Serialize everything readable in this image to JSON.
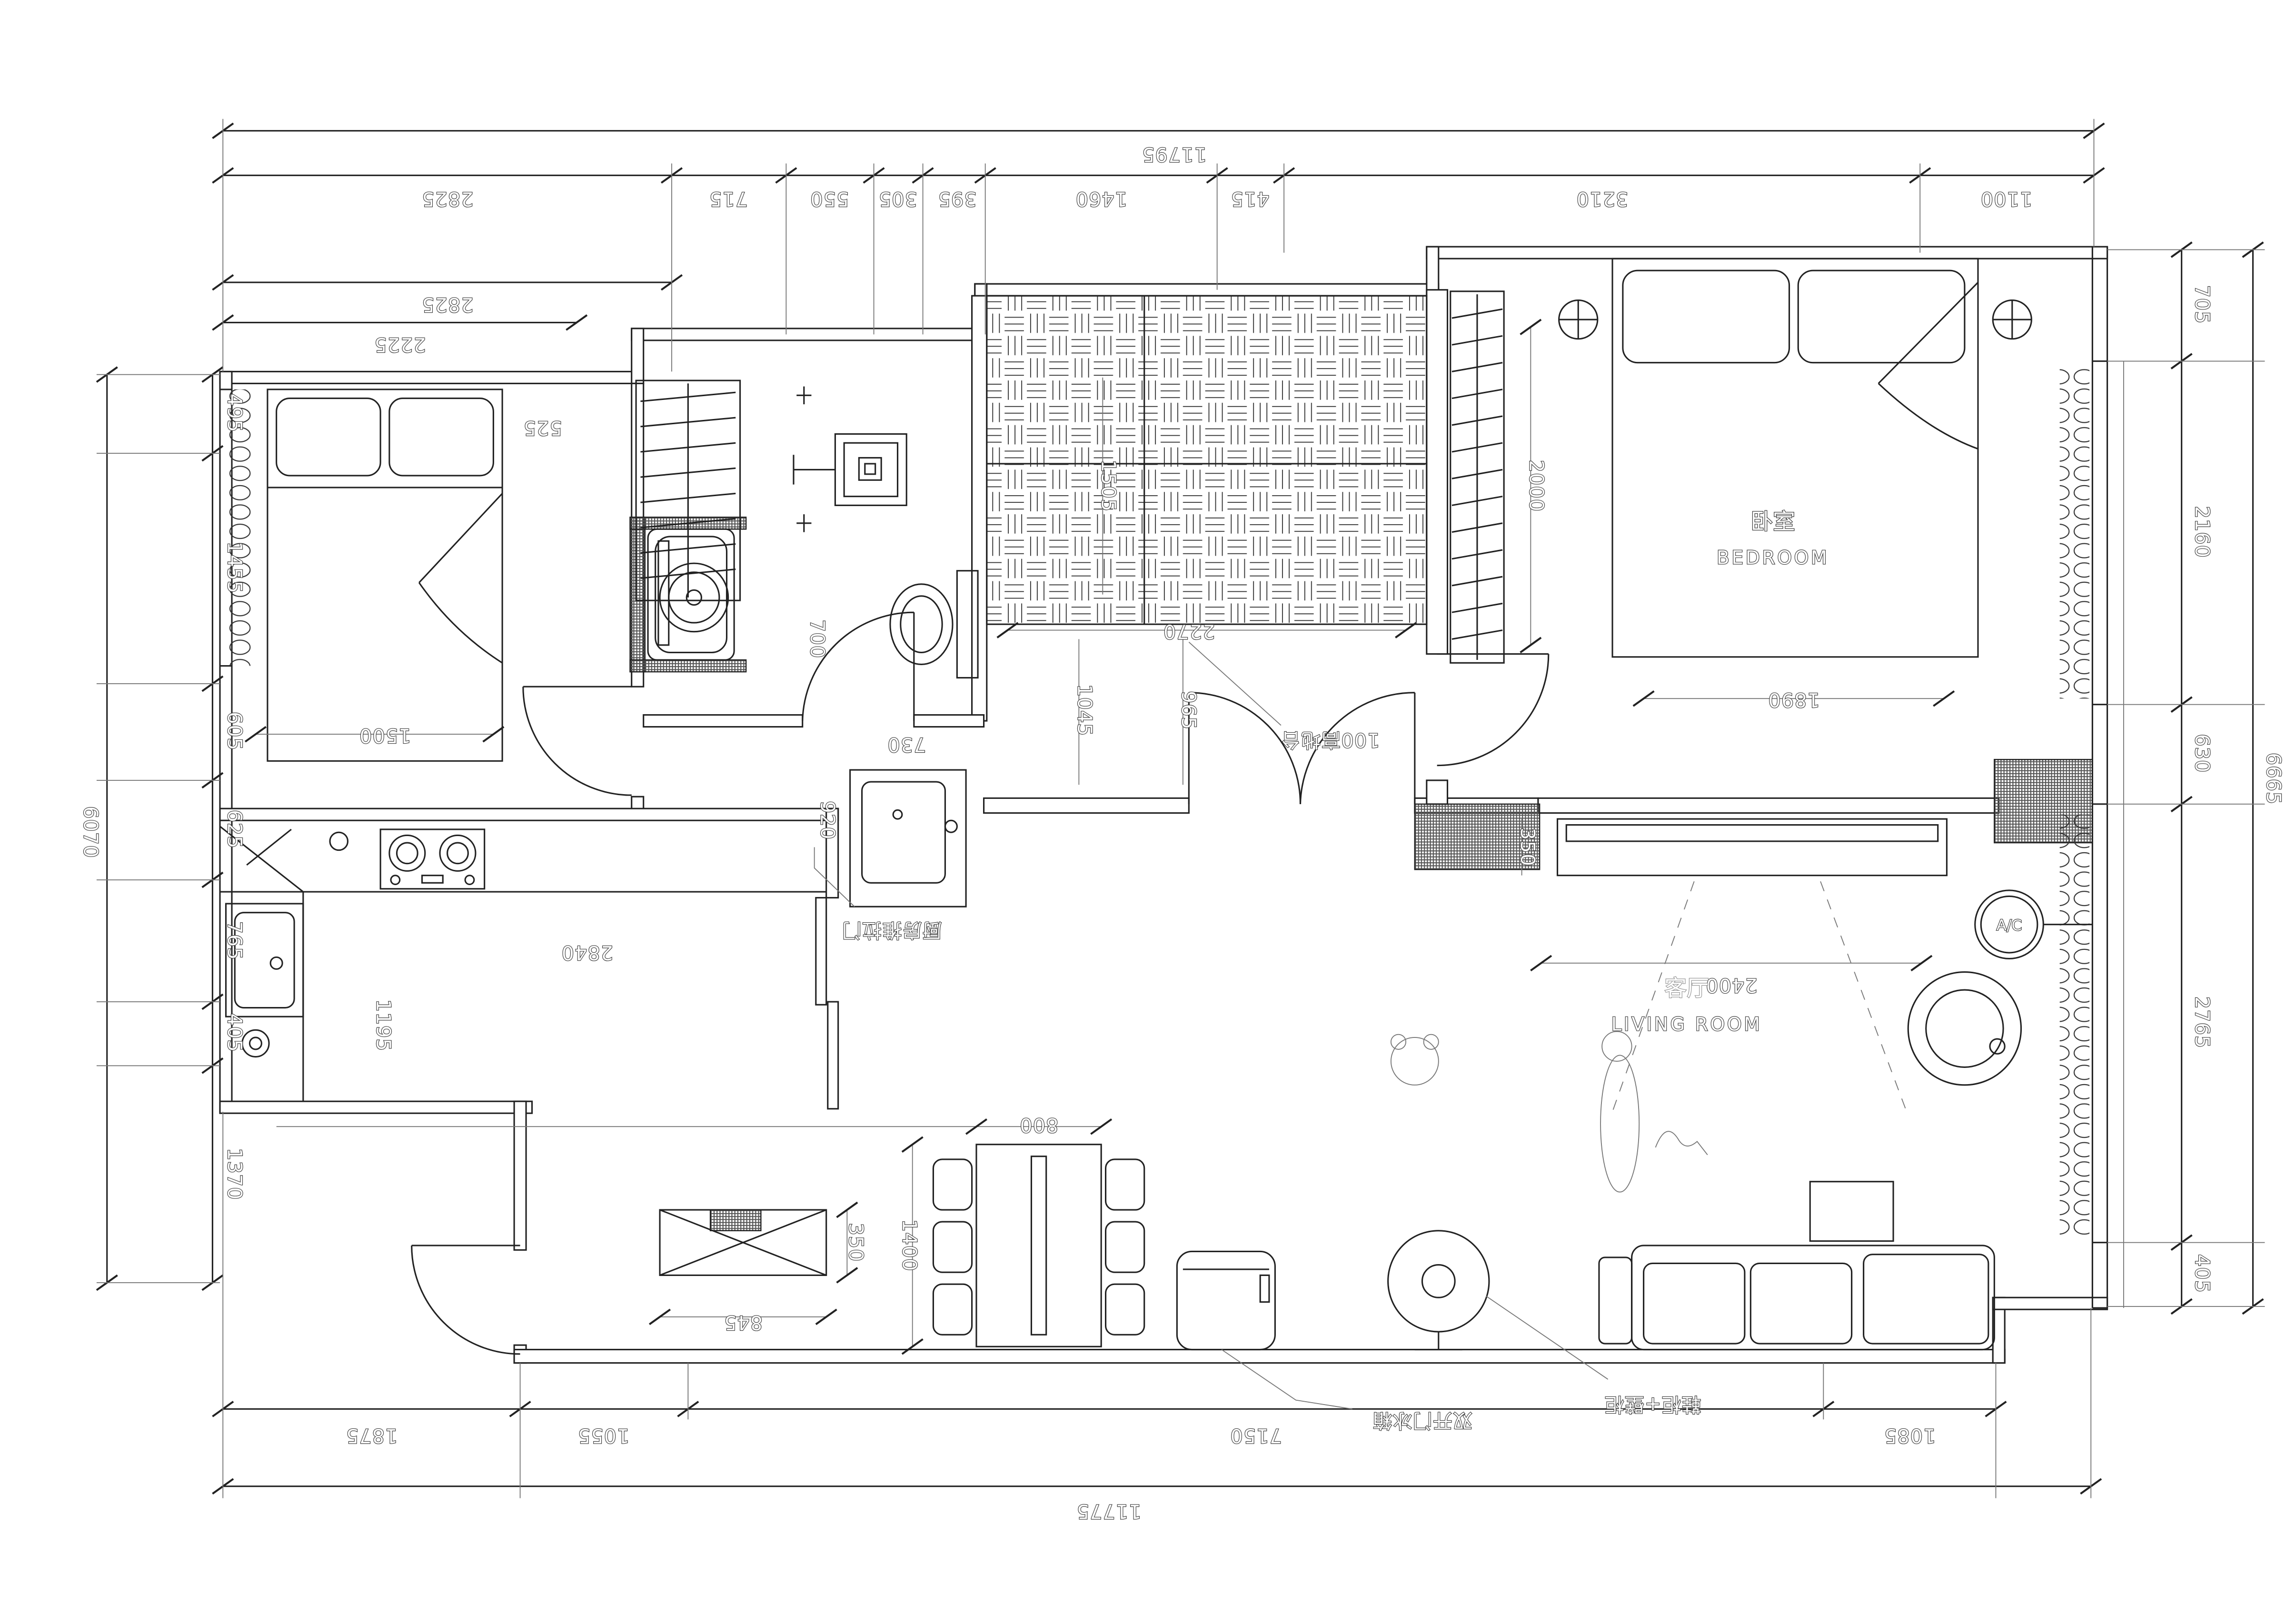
{
  "rooms": {
    "bedroom_zh": "卧室",
    "bedroom_en": "BEDROOM",
    "living_zh": "客厅",
    "living_en": "LIVING ROOM",
    "ac": "A/C"
  },
  "annotations": {
    "platform": "100高地台",
    "kitchen_door": "厨房推拉门",
    "fridge": "双开门冰箱",
    "entry_cabinet": "鞋柜+壁柜"
  },
  "dims": {
    "top_total": "11795",
    "top": [
      "2825",
      "715",
      "550",
      "305",
      "395",
      "1460",
      "415",
      "3210",
      "1100"
    ],
    "top_row2": "2825",
    "top_row3": "2225",
    "left": [
      "495",
      "1455",
      "605",
      "625",
      "765",
      "405",
      "1370"
    ],
    "left_total": "6070",
    "right": [
      "705",
      "2160",
      "630",
      "2765",
      "405"
    ],
    "right_total": "6665",
    "bottom": [
      "1875",
      "1055",
      "7150",
      "1085"
    ],
    "bottom_total": "11775",
    "interior": {
      "bed2_w": "1500",
      "wardrobe2_w": "525",
      "bath_door": "700",
      "vanity_w": "730",
      "hall_w": "920",
      "kitchen_w": "2840",
      "kitchen_d": "1195",
      "shoe_w": "845",
      "shoe_d": "350",
      "table_w": "800",
      "table_l": "1400",
      "platform_w": "2270",
      "platform_h": "1505",
      "hall_len1": "1045",
      "hall_len2": "965",
      "wardrobe1_h": "2000",
      "bed1_w": "1890",
      "tv_d": "350",
      "tv_span": "2400"
    }
  },
  "colors": {
    "line": "#222222",
    "background": "#ffffff"
  }
}
